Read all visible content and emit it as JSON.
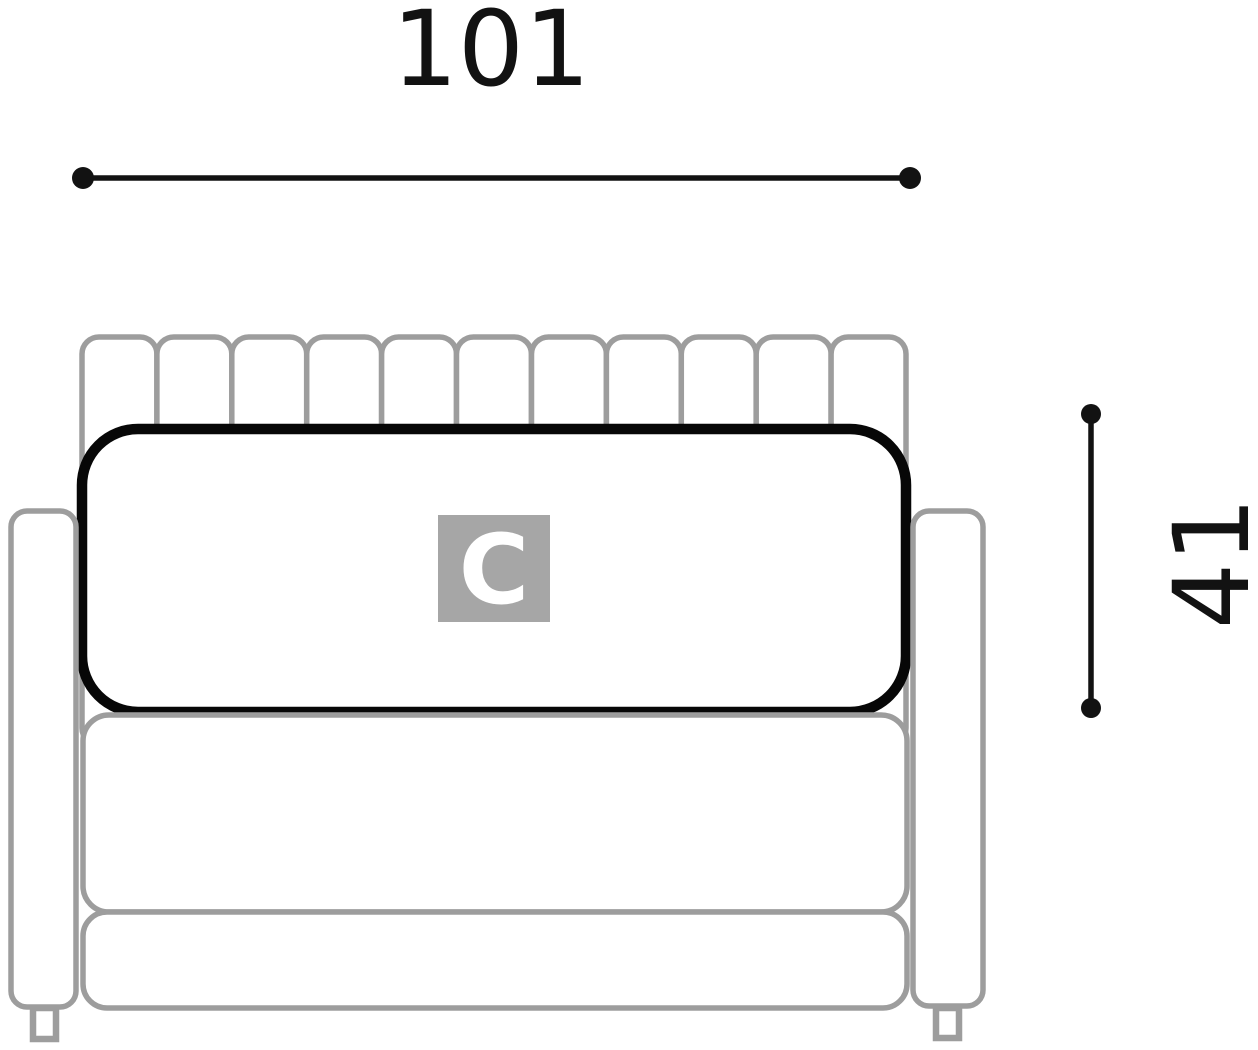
{
  "diagram": {
    "dimensions": {
      "width": {
        "label": "101"
      },
      "height": {
        "label": "41"
      }
    },
    "module": {
      "label": "C"
    },
    "sofa": {
      "backrest_channel_count": 11
    },
    "colors": {
      "outline": "#9d9d9d",
      "highlight": "#070707",
      "dimension": "#121212",
      "badge_bg": "#a6a6a6",
      "badge_text": "#ffffff"
    }
  }
}
